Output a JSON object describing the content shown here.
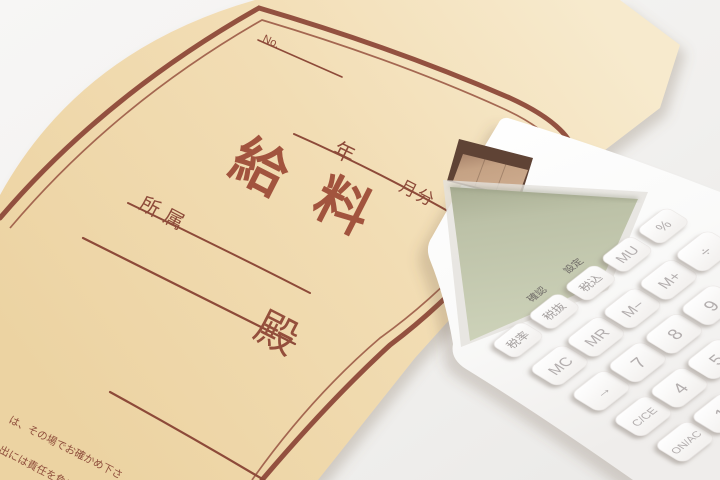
{
  "scene": {
    "subject": "salary envelope with calculator photo"
  },
  "envelope": {
    "no_label": "No.",
    "year_label": "年",
    "month_label": "月分",
    "title_chars": [
      "給",
      "料"
    ],
    "department_label": "所属",
    "honorific": "殿",
    "notice_line1": "は、その場でお確かめ下さ",
    "notice_line2": "出には責任を負いかね",
    "paper_color": "#f1dcb3",
    "print_color": "#8d4a39",
    "title_color": "#a2543e"
  },
  "calculator": {
    "body_color": "#fbfbfa",
    "lcd_color": "#c4c9b0",
    "solar_color": "#c2a183",
    "key_text_color": "#b3aeae",
    "indicators": [
      "確認",
      "設定"
    ],
    "keys": [
      {
        "label": "税率"
      },
      {
        "label": "税抜"
      },
      {
        "label": "税込"
      },
      {
        "label": "MU"
      },
      {
        "label": "%"
      },
      {
        "label": "MC"
      },
      {
        "label": "MR"
      },
      {
        "label": "M−"
      },
      {
        "label": "M+"
      },
      {
        "label": "÷"
      },
      {
        "label": "→"
      },
      {
        "label": "7"
      },
      {
        "label": "8"
      },
      {
        "label": "9"
      },
      {
        "label": "C/CE"
      },
      {
        "label": "4"
      },
      {
        "label": "5"
      },
      {
        "label": "ON/AC"
      },
      {
        "label": "1"
      }
    ]
  }
}
